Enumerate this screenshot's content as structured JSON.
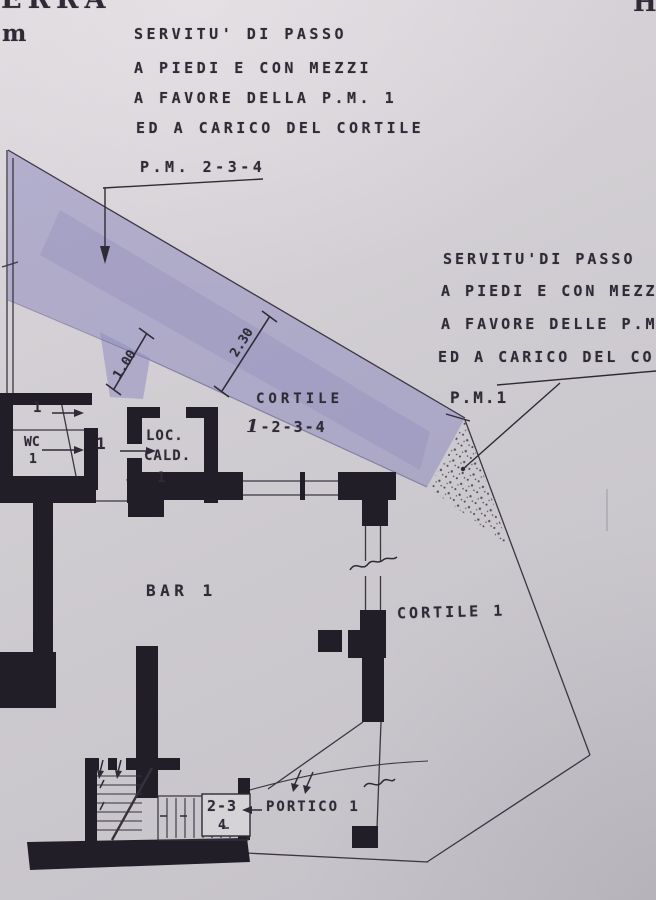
{
  "document": {
    "type": "cadastral floor plan (planimetria catastale, scanned)",
    "colors": {
      "paper": "#cdc9cf",
      "ink": "#2f2b36",
      "wall": "#211e27",
      "servitude_band": "#8f8dc0"
    }
  },
  "corner_marks": {
    "top_left_line1": "ERRA",
    "top_left_line2": "m",
    "top_right": "H"
  },
  "left_note": {
    "lines": [
      "SERVITU' DI PASSO",
      "A PIEDI E CON MEZZI",
      "A FAVORE DELLA P.M. 1",
      "ED A CARICO DEL CORTILE",
      "P.M. 2-3-4"
    ]
  },
  "right_note": {
    "lines": [
      "SERVITU'DI PASSO",
      "A PIEDI E CON MEZZ",
      "A FAVORE DELLE P.M",
      "ED A CARICO DEL CO",
      "P.M.1"
    ]
  },
  "dimensions": {
    "passage_width": "1.00",
    "band_width": "2.30"
  },
  "rooms": {
    "courtyard_shared_name": "CORTILE",
    "courtyard_shared_units_prefix": "1",
    "courtyard_shared_units_rest": "-2-3-4",
    "bar": "BAR 1",
    "courtyard_1": "CORTILE 1",
    "portico": "PORTICO 1",
    "wc_line1": "WC",
    "wc_line2": "1",
    "boiler_line1": "LOC.",
    "boiler_line2": "CALD.",
    "boiler_line3": "1",
    "room_top": "1",
    "room_mid": "1",
    "stair_units": "2-3",
    "stair_unit_4": "4"
  }
}
